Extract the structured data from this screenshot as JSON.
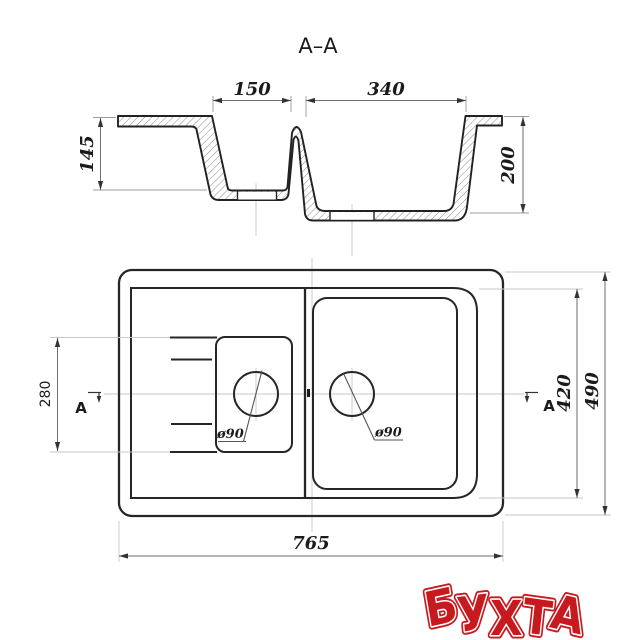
{
  "drawing": {
    "section": {
      "title": "A–A",
      "dim_small_basin_width": "150",
      "dim_large_basin_width": "340",
      "dim_small_basin_depth": "145",
      "dim_large_basin_depth": "200"
    },
    "plan": {
      "dim_drainboard_length": "280",
      "dim_inner_width": "420",
      "dim_overall_width": "490",
      "dim_overall_length": "765",
      "drain_small_label": "ø90",
      "drain_large_label": "ø90",
      "section_marker_left": "A",
      "section_marker_right": "A"
    },
    "logo_text": "БУХТА"
  },
  "colors": {
    "object_line": "#262626",
    "dimension_line": "#6e6e6e",
    "construction_line": "#c7c7c7",
    "text": "#1b1b1b",
    "logo_red": "#c8191f",
    "background": "#ffffff"
  }
}
